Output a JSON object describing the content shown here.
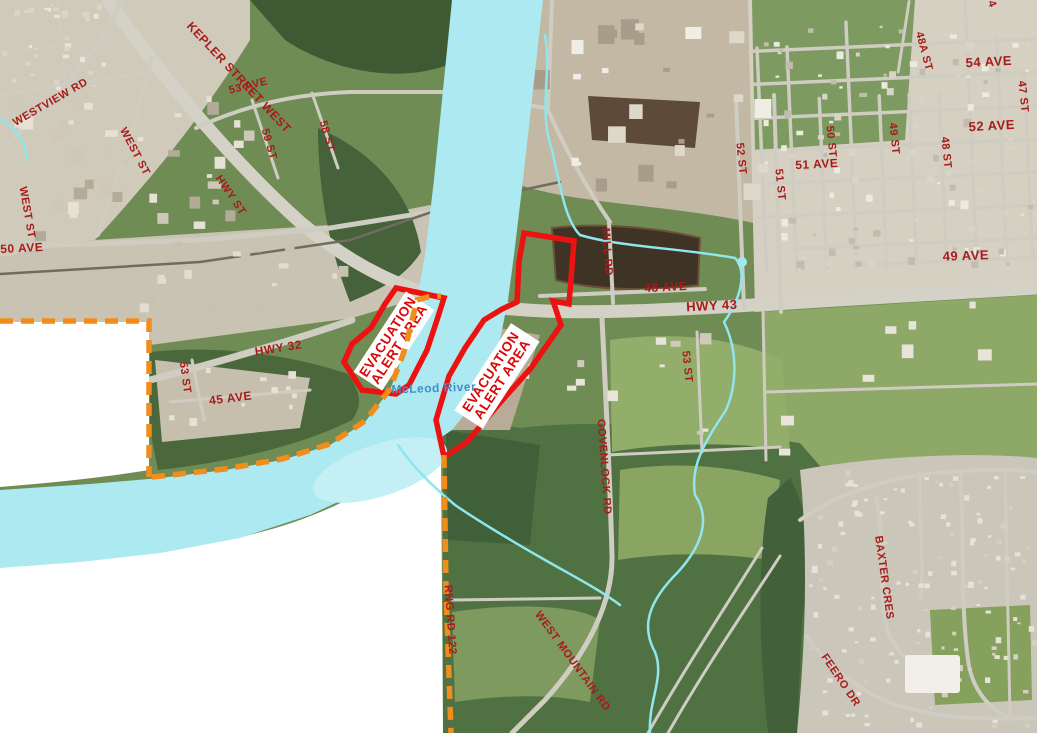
{
  "map": {
    "river_label": "McLeod River",
    "colors": {
      "boundary": "#F28C1A",
      "zone_outline": "#EE1111",
      "zone_text": "#DD0606",
      "road_label": "#A81B1B",
      "river_label_color": "#3F8FCB",
      "water": "#ACE9F0",
      "stream": "#8FE6EC"
    },
    "zones": [
      {
        "label_line1": "EVACUATION",
        "label_line2": "ALERT AREA",
        "x": 394,
        "y": 341,
        "rotate": -57
      },
      {
        "label_line1": "EVACUATION",
        "label_line2": "ALERT AREA",
        "x": 497,
        "y": 376,
        "rotate": -57
      }
    ],
    "labels": [
      {
        "text": "KEPLER STREET WEST",
        "x": 236,
        "y": 80,
        "rotate": 47,
        "size": 12
      },
      {
        "text": "WESTVIEW RD",
        "x": 52,
        "y": 105,
        "rotate": -30,
        "size": 11
      },
      {
        "text": "WEST ST",
        "x": 132,
        "y": 153,
        "rotate": 62,
        "size": 11
      },
      {
        "text": "WEST ST",
        "x": 24,
        "y": 213,
        "rotate": 80,
        "size": 11
      },
      {
        "text": "53 AVE",
        "x": 249,
        "y": 89,
        "rotate": -14,
        "size": 11
      },
      {
        "text": "59 ST",
        "x": 266,
        "y": 145,
        "rotate": 74,
        "size": 11
      },
      {
        "text": "58 ST",
        "x": 324,
        "y": 137,
        "rotate": 74,
        "size": 11
      },
      {
        "text": "HWY ST",
        "x": 228,
        "y": 197,
        "rotate": 56,
        "size": 11
      },
      {
        "text": "50 AVE",
        "x": 22,
        "y": 252,
        "rotate": -3,
        "size": 12
      },
      {
        "text": "HWY 32",
        "x": 279,
        "y": 352,
        "rotate": -9,
        "size": 12
      },
      {
        "text": "45 AVE",
        "x": 231,
        "y": 402,
        "rotate": -7,
        "size": 12
      },
      {
        "text": "53 ST",
        "x": 182,
        "y": 378,
        "rotate": 82,
        "size": 11
      },
      {
        "text": "MILL RD",
        "x": 604,
        "y": 252,
        "rotate": 86,
        "size": 11
      },
      {
        "text": "48 AVE",
        "x": 666,
        "y": 291,
        "rotate": -3,
        "size": 12
      },
      {
        "text": "HWY 43",
        "x": 712,
        "y": 310,
        "rotate": -3,
        "size": 13
      },
      {
        "text": "52 ST",
        "x": 738,
        "y": 159,
        "rotate": 84,
        "size": 11
      },
      {
        "text": "51 ST",
        "x": 777,
        "y": 185,
        "rotate": 84,
        "size": 11
      },
      {
        "text": "51 AVE",
        "x": 817,
        "y": 168,
        "rotate": -3,
        "size": 12
      },
      {
        "text": "50 ST",
        "x": 828,
        "y": 142,
        "rotate": 84,
        "size": 11
      },
      {
        "text": "49 ST",
        "x": 891,
        "y": 139,
        "rotate": 84,
        "size": 11
      },
      {
        "text": "48 ST",
        "x": 943,
        "y": 153,
        "rotate": 84,
        "size": 11
      },
      {
        "text": "48A ST",
        "x": 921,
        "y": 52,
        "rotate": 75,
        "size": 11
      },
      {
        "text": "54 AVE",
        "x": 989,
        "y": 66,
        "rotate": -3,
        "size": 13
      },
      {
        "text": "47 ST",
        "x": 1020,
        "y": 97,
        "rotate": 84,
        "size": 11
      },
      {
        "text": "52 AVE",
        "x": 992,
        "y": 130,
        "rotate": -3,
        "size": 13
      },
      {
        "text": "49 AVE",
        "x": 966,
        "y": 260,
        "rotate": -2,
        "size": 13
      },
      {
        "text": "53 ST",
        "x": 684,
        "y": 367,
        "rotate": 84,
        "size": 11
      },
      {
        "text": "GOVENLOCK RD",
        "x": 601,
        "y": 467,
        "rotate": 86,
        "size": 11
      },
      {
        "text": "RNG RD 122",
        "x": 447,
        "y": 620,
        "rotate": 86,
        "size": 11
      },
      {
        "text": "WEST MOUNTAIN RD",
        "x": 570,
        "y": 663,
        "rotate": 54,
        "size": 11
      },
      {
        "text": "BAXTER CRES",
        "x": 881,
        "y": 578,
        "rotate": 82,
        "size": 11
      },
      {
        "text": "FEERO DR",
        "x": 838,
        "y": 682,
        "rotate": 56,
        "size": 11
      },
      {
        "text": "4",
        "x": 989,
        "y": 5,
        "rotate": 70,
        "size": 11
      },
      {
        "text": "McLeod River",
        "x": 434,
        "y": 392,
        "rotate": -2,
        "size": 12,
        "color": "#3F8FCB"
      }
    ]
  }
}
